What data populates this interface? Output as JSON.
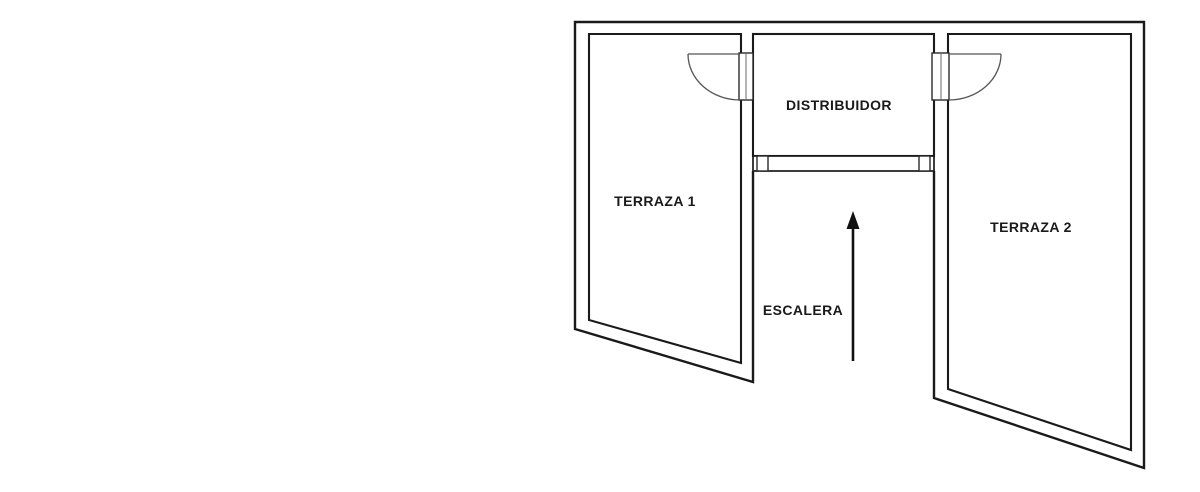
{
  "canvas": {
    "background": "#ffffff"
  },
  "floorplan": {
    "type": "floor-plan",
    "colors": {
      "wall": "#1a1a1a",
      "door": "#555555",
      "text": "#1a1a1a",
      "background": "#ffffff"
    },
    "rooms": [
      {
        "name": "terraza-1",
        "label": "TERRAZA 1"
      },
      {
        "name": "distribuidor",
        "label": "DISTRIBUIDOR"
      },
      {
        "name": "terraza-2",
        "label": "TERRAZA 2"
      },
      {
        "name": "escalera",
        "label": "ESCALERA"
      }
    ],
    "stairs_arrow": {
      "icon": "arrow-up-icon",
      "direction": "up"
    }
  }
}
